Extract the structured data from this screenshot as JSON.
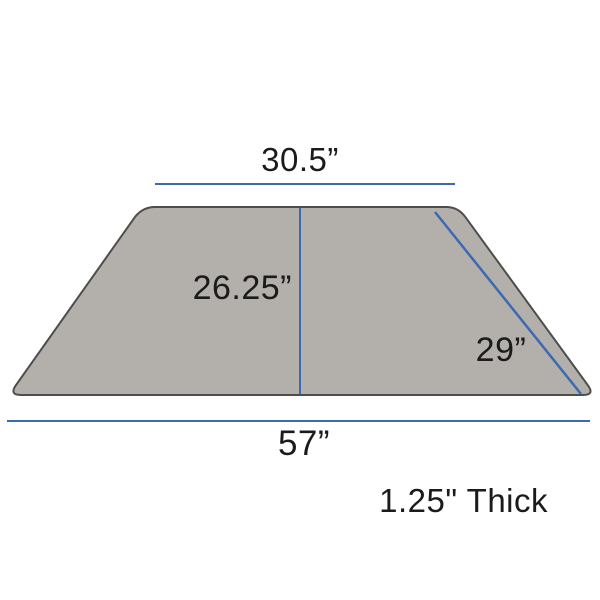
{
  "diagram": {
    "shape": "trapezoid-tabletop",
    "labels": {
      "top_width": "30.5”",
      "height": "26.25”",
      "side_length": "29”",
      "bottom_width": "57”",
      "thickness": "1.25\" Thick"
    },
    "colors": {
      "dimension_line": "#3c69b1",
      "surface_fill": "#b3b0ac",
      "surface_border": "#4d4d4b",
      "label_text": "#1b1b1b",
      "background": "#ffffff"
    }
  }
}
